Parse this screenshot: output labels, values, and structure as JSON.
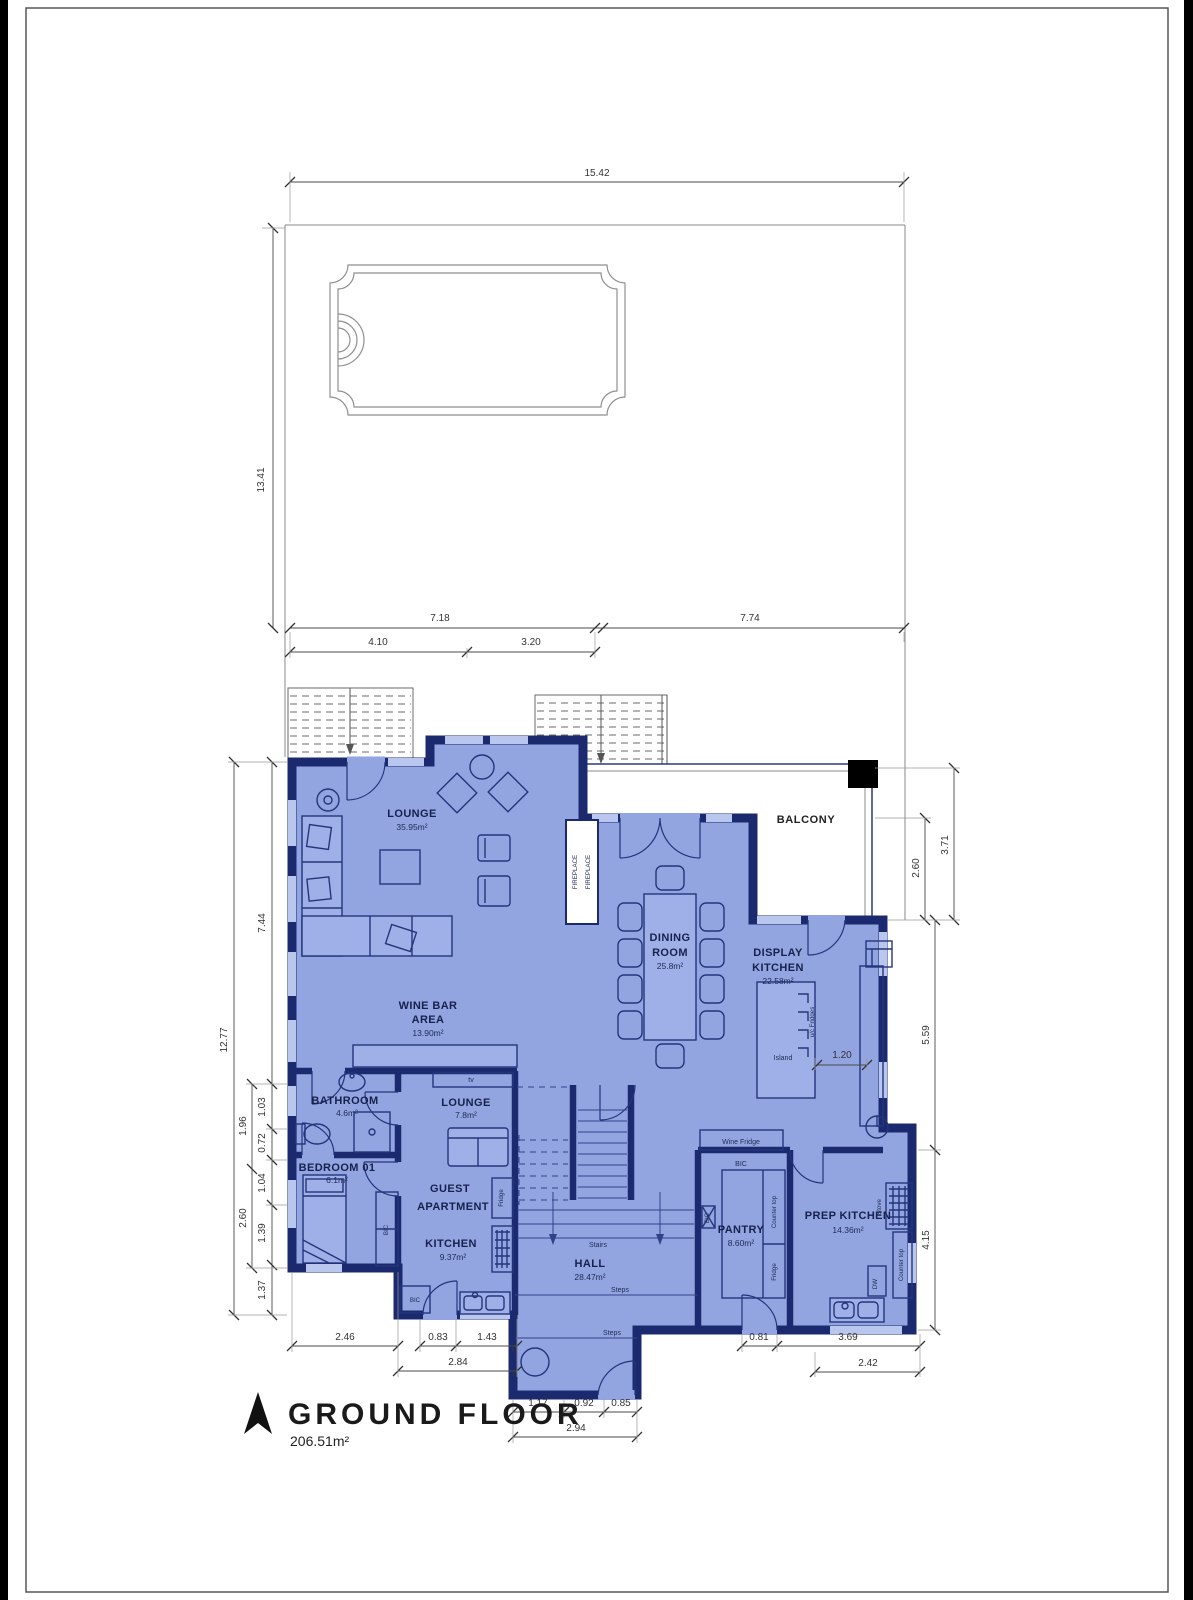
{
  "title": {
    "name": "GROUND FLOOR",
    "area": "206.51m²"
  },
  "rooms": {
    "lounge": {
      "name": "LOUNGE",
      "area": "35.95m²"
    },
    "wine_bar": {
      "line1": "WINE BAR",
      "line2": "AREA",
      "area": "13.90m²"
    },
    "dining": {
      "line1": "DINING",
      "line2": "ROOM",
      "area": "25.8m²"
    },
    "display_kitchen": {
      "line1": "DISPLAY",
      "line2": "KITCHEN",
      "area": "22.58m²"
    },
    "balcony": {
      "name": "BALCONY"
    },
    "bathroom": {
      "name": "BATHROOM",
      "area": "4.6m²"
    },
    "bedroom": {
      "name": "BEDROOM 01",
      "area": "6.1m²"
    },
    "guest_lounge": {
      "name": "LOUNGE",
      "area": "7.8m²"
    },
    "guest_apartment": {
      "line1": "GUEST",
      "line2": "APARTMENT"
    },
    "guest_kitchen": {
      "name": "KITCHEN",
      "area": "9.37m²"
    },
    "hall": {
      "name": "HALL",
      "area": "28.47m²"
    },
    "pantry": {
      "name": "PANTRY",
      "area": "8.60m²"
    },
    "prep_kitchen": {
      "name": "PREP KITCHEN",
      "area": "14.36m²"
    }
  },
  "annotations": {
    "fireplace": "FIREPLACE",
    "island": "Island",
    "uc_fridges": "u/c Fridges",
    "wine_fridge": "Wine Fridge",
    "bic": "BIC",
    "counter_top": "Counter top",
    "fridge": "Fridge",
    "stove": "Stove",
    "dw": "DW",
    "tv": "tv",
    "stairs": "Stairs",
    "steps": "Steps"
  },
  "dims": {
    "site_top": "15.42",
    "site_left": "13.41",
    "upper": [
      "7.18",
      "7.74"
    ],
    "upper2": [
      "4.10",
      "3.20"
    ],
    "left_overall": "12.77",
    "left": [
      "7.44",
      "1.03",
      "0.72",
      "1.04",
      "1.39",
      "1.37"
    ],
    "left_mid": [
      "1.96",
      "2.60"
    ],
    "right": [
      "3.71",
      "2.60",
      "5.59",
      "4.15"
    ],
    "bottom_left": [
      "2.46",
      "0.83",
      "1.43"
    ],
    "bottom_left_total": "2.84",
    "entrance": [
      "1.17",
      "0.92",
      "0.85"
    ],
    "entrance_total": "2.94",
    "bottom_right": [
      "0.81",
      "3.69"
    ],
    "bottom_right_total": "2.42",
    "island": "1.20"
  },
  "colors": {
    "wall": "#1b2a6e",
    "floor_fill": "#92a5e0",
    "window": "#b9c7ee",
    "balcony": "#ffffff",
    "paper": "#ffffff",
    "dim_text": "#333333",
    "label_text": "#16214e"
  }
}
